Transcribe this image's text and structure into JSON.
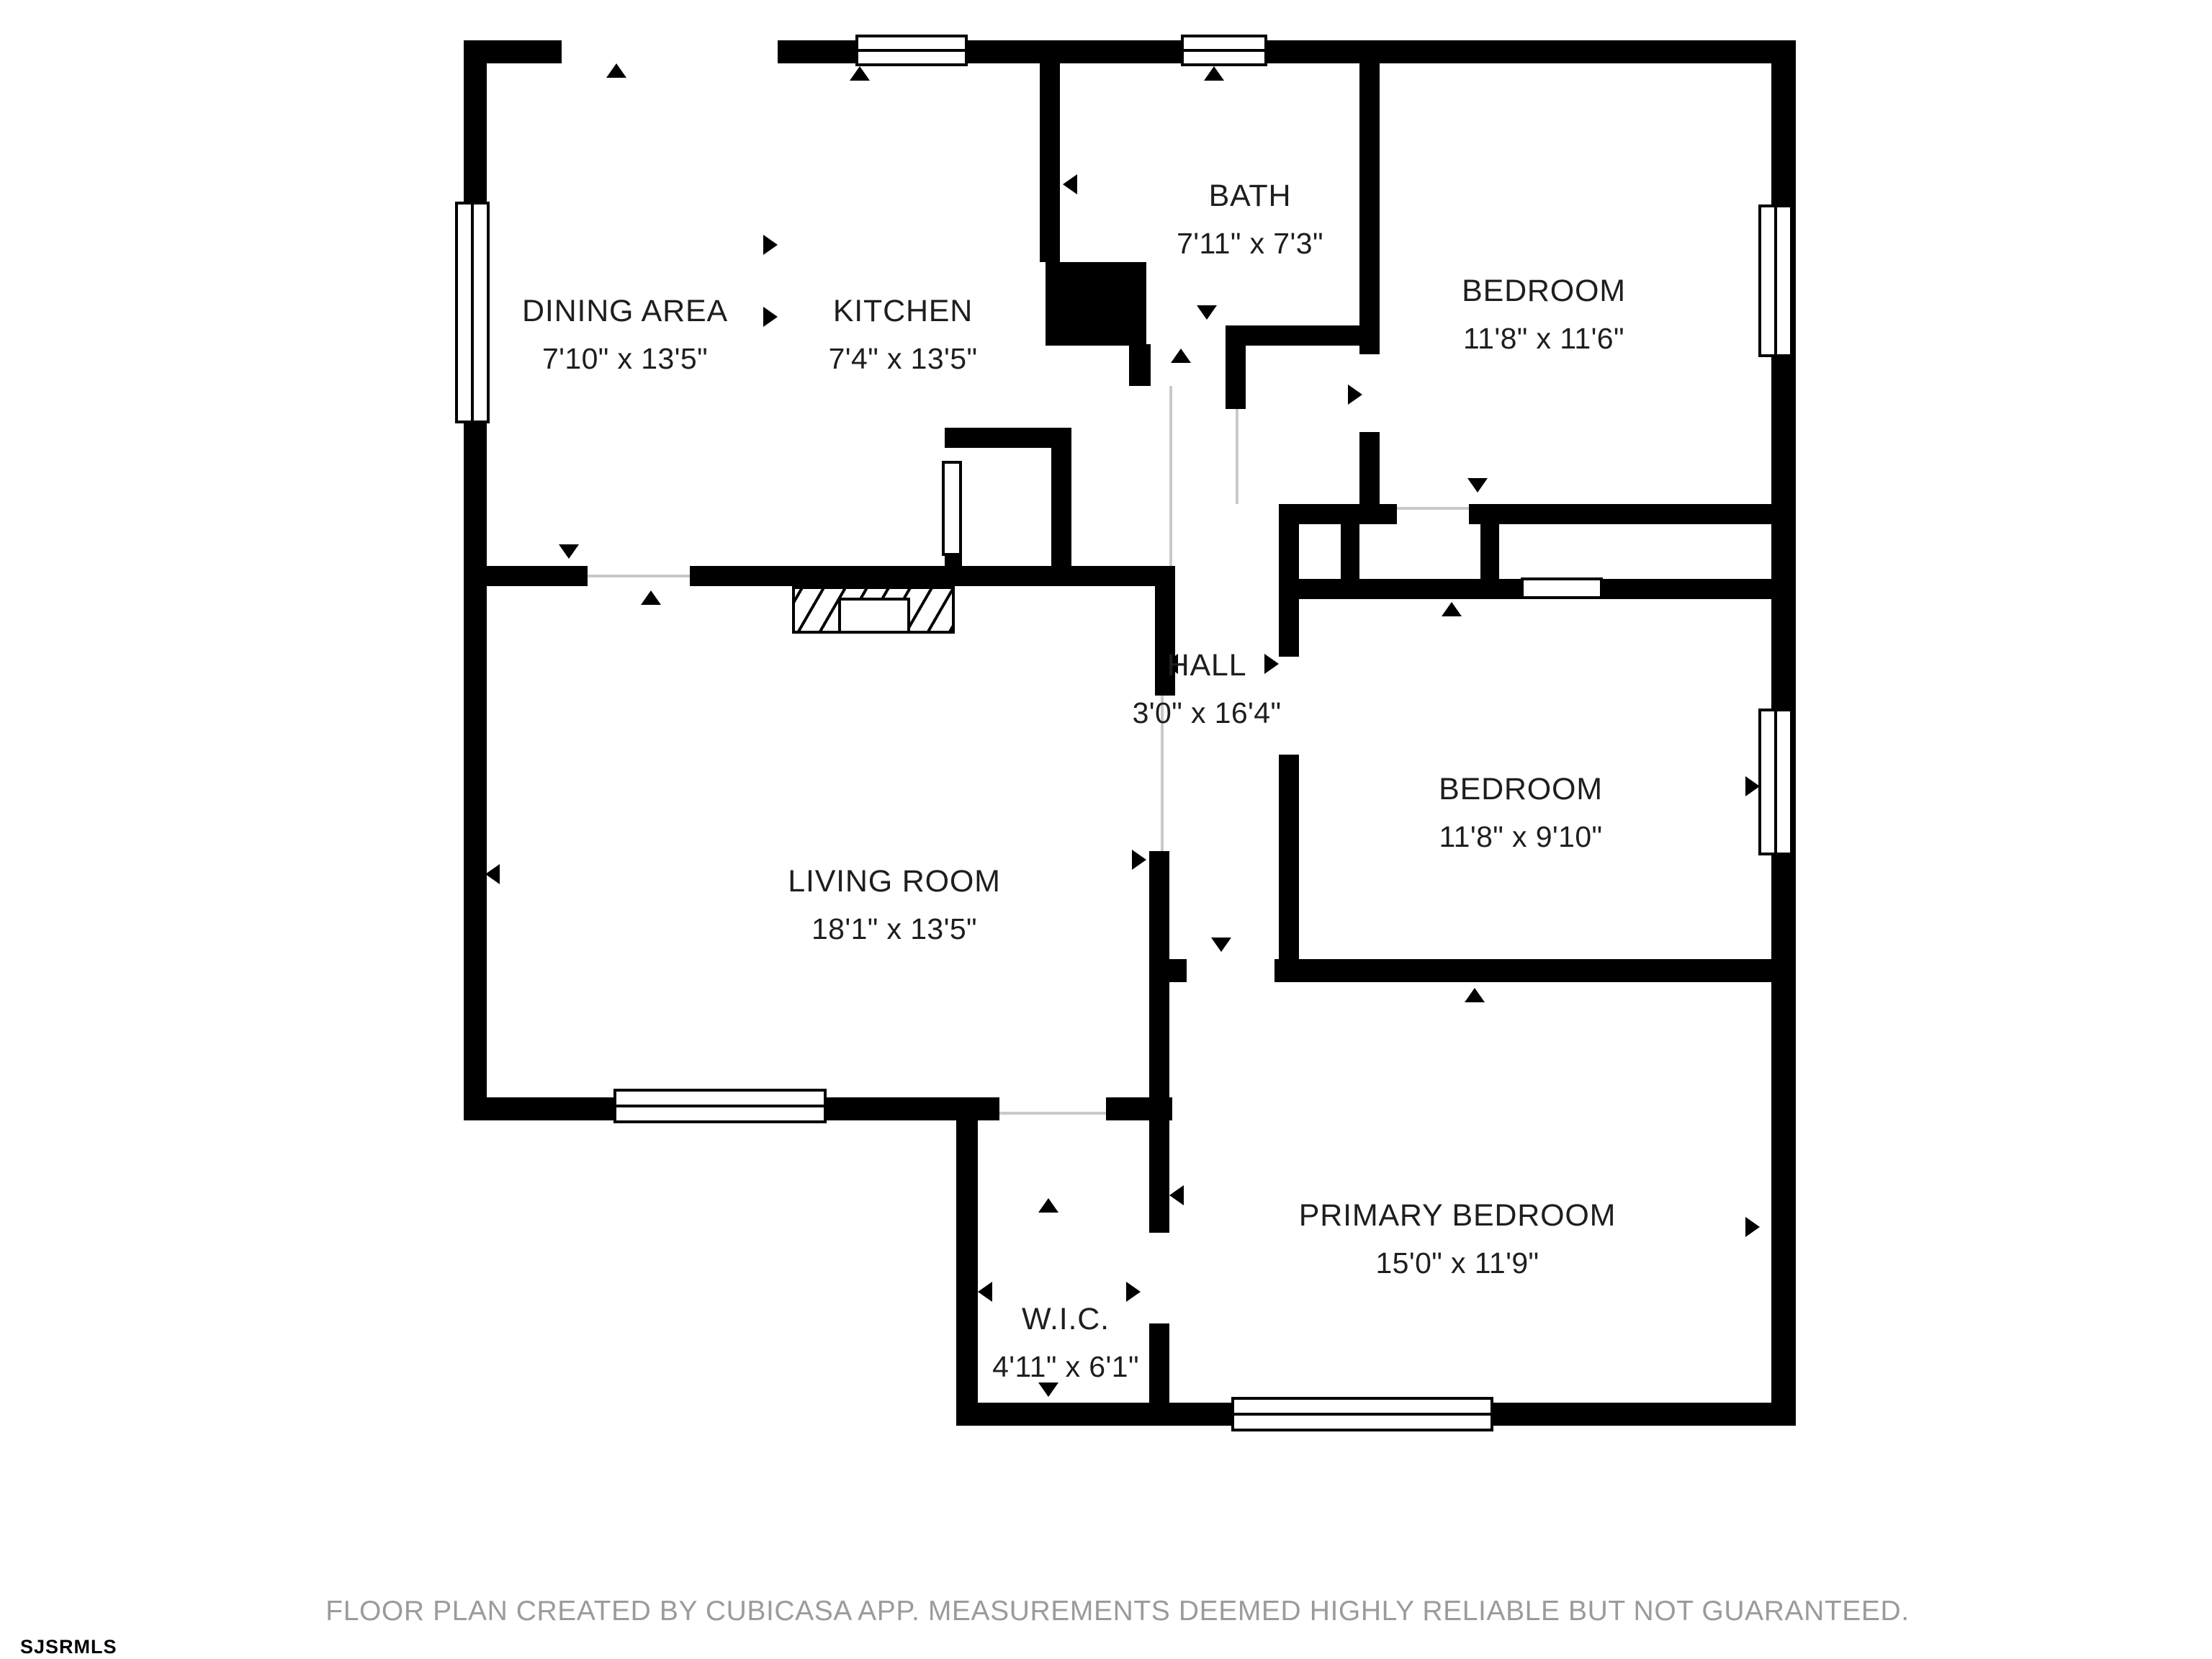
{
  "rooms": {
    "dining": {
      "name": "DINING AREA",
      "dims": "7'10\" x 13'5\""
    },
    "kitchen": {
      "name": "KITCHEN",
      "dims": "7'4\" x 13'5\""
    },
    "bath": {
      "name": "BATH",
      "dims": "7'11\" x 7'3\""
    },
    "bedroom_top": {
      "name": "BEDROOM",
      "dims": "11'8\" x 11'6\""
    },
    "hall": {
      "name": "HALL",
      "dims": "3'0\" x 16'4\""
    },
    "bedroom_mid": {
      "name": "BEDROOM",
      "dims": "11'8\" x 9'10\""
    },
    "living": {
      "name": "LIVING ROOM",
      "dims": "18'1\" x 13'5\""
    },
    "primary": {
      "name": "PRIMARY BEDROOM",
      "dims": "15'0\" x 11'9\""
    },
    "wic": {
      "name": "W.I.C.",
      "dims": "4'11\" x 6'1\""
    }
  },
  "footer": {
    "disclaimer": "FLOOR PLAN CREATED BY CUBICASA APP. MEASUREMENTS DEEMED HIGHLY RELIABLE BUT NOT GUARANTEED."
  },
  "watermark": "SJSRMLS",
  "colors": {
    "wall": "#000000",
    "text": "#1e1e1e",
    "muted": "#9b9b9b"
  }
}
